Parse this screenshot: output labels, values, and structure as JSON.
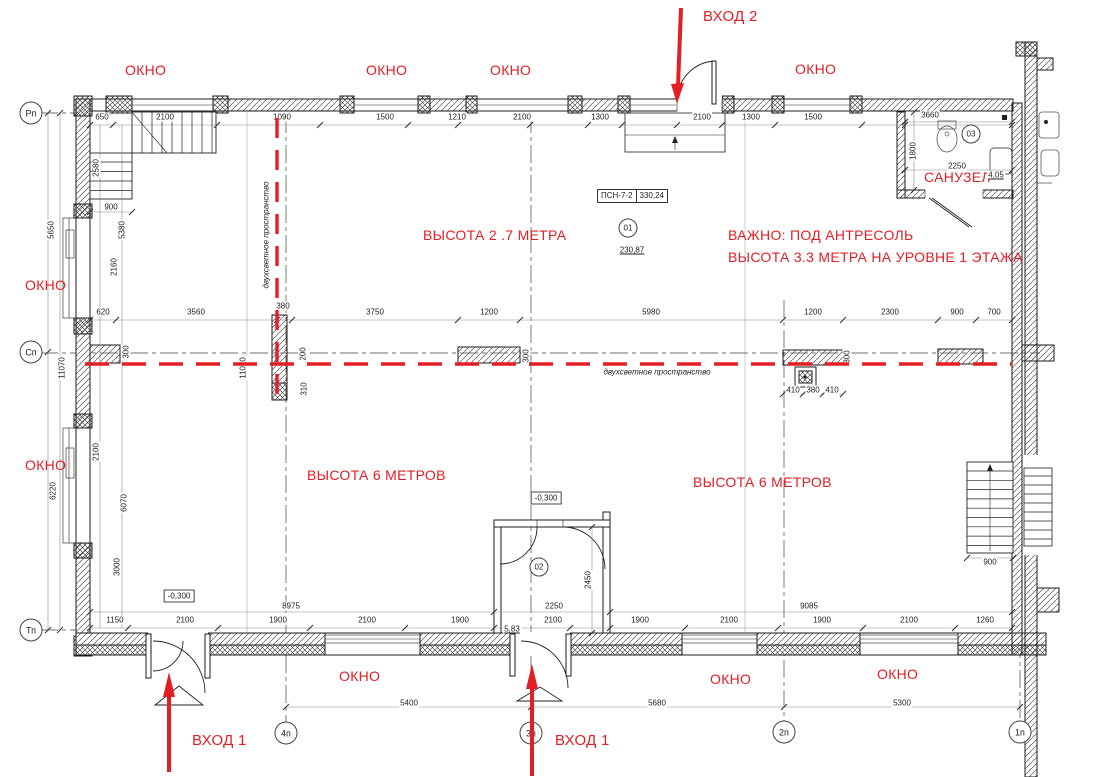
{
  "palette": {
    "red": "#e31e24",
    "line": "#1c1c1c",
    "dim_text": "#222222",
    "background": "#ffffff"
  },
  "area_tag": {
    "code": "ПСН-7-2",
    "area": "330,24"
  },
  "red_annotations": [
    {
      "text": "ВХОД 2",
      "x": 703,
      "y": 9,
      "size": 15
    },
    {
      "text": "ОКНО",
      "x": 125,
      "y": 62
    },
    {
      "text": "ОКНО",
      "x": 366,
      "y": 62
    },
    {
      "text": "ОКНО",
      "x": 490,
      "y": 62
    },
    {
      "text": "ОКНО",
      "x": 795,
      "y": 61
    },
    {
      "text": "ОКНО",
      "x": 25,
      "y": 277
    },
    {
      "text": "ОКНО",
      "x": 25,
      "y": 457
    },
    {
      "text": "ВЫСОТА 2 .7 МЕТРА",
      "x": 423,
      "y": 227
    },
    {
      "text": "ВАЖНО: ПОД АНТРЕСОЛЬ",
      "x": 728,
      "y": 227
    },
    {
      "text": "ВЫСОТА 3.3 МЕТРА НА УРОВНЕ 1 ЭТАЖА",
      "x": 728,
      "y": 249
    },
    {
      "text": "ВЫСОТА 6 МЕТРОВ",
      "x": 307,
      "y": 467
    },
    {
      "text": "ВЫСОТА 6 МЕТРОВ",
      "x": 693,
      "y": 474
    },
    {
      "text": "САНУЗЕЛ",
      "x": 924,
      "y": 169
    },
    {
      "text": "ОКНО",
      "x": 339,
      "y": 668
    },
    {
      "text": "ОКНО",
      "x": 710,
      "y": 671
    },
    {
      "text": "ОКНО",
      "x": 877,
      "y": 666
    },
    {
      "text": "ВХОД 1",
      "x": 192,
      "y": 733,
      "size": 15
    },
    {
      "text": "ВХОД 1",
      "x": 555,
      "y": 733,
      "size": 15
    }
  ],
  "grid_bubbles": [
    {
      "text": "Рп",
      "x": 31,
      "y": 113
    },
    {
      "text": "Сп",
      "x": 31,
      "y": 352
    },
    {
      "text": "Тп",
      "x": 31,
      "y": 630
    },
    {
      "text": "4п",
      "x": 286,
      "y": 733
    },
    {
      "text": "3п",
      "x": 531,
      "y": 733
    },
    {
      "text": "2п",
      "x": 784,
      "y": 732
    },
    {
      "text": "1п",
      "x": 1020,
      "y": 732
    }
  ],
  "circles": [
    {
      "text": "01",
      "x": 628,
      "y": 228
    },
    {
      "text": "02",
      "x": 539,
      "y": 567
    },
    {
      "text": "03",
      "x": 971,
      "y": 134
    }
  ],
  "level_boxes": [
    {
      "text": "-0,300",
      "x": 179,
      "y": 596
    },
    {
      "text": "-0,300",
      "x": 546,
      "y": 498
    }
  ],
  "underlined": [
    {
      "text": "230,87",
      "x": 632,
      "y": 250
    },
    {
      "text": "4,05",
      "x": 996,
      "y": 175
    },
    {
      "text": "5,83",
      "x": 512,
      "y": 629
    }
  ],
  "notes": [
    {
      "text": "двухсветное пространство",
      "x": 657,
      "y": 372
    },
    {
      "text": "двухсветное пространство",
      "x": 266,
      "y": 235,
      "rot": 1
    }
  ],
  "dims": [
    {
      "text": "650",
      "x": 102,
      "y": 117
    },
    {
      "text": "2100",
      "x": 165,
      "y": 117
    },
    {
      "text": "1090",
      "x": 282,
      "y": 117
    },
    {
      "text": "1500",
      "x": 385,
      "y": 117
    },
    {
      "text": "1210",
      "x": 457,
      "y": 117
    },
    {
      "text": "2100",
      "x": 522,
      "y": 117
    },
    {
      "text": "1300",
      "x": 600,
      "y": 117
    },
    {
      "text": "2100",
      "x": 702,
      "y": 117
    },
    {
      "text": "1300",
      "x": 751,
      "y": 117
    },
    {
      "text": "1500",
      "x": 813,
      "y": 117
    },
    {
      "text": "3660",
      "x": 930,
      "y": 115
    },
    {
      "text": "620",
      "x": 103,
      "y": 312
    },
    {
      "text": "3560",
      "x": 196,
      "y": 312
    },
    {
      "text": "380",
      "x": 283,
      "y": 306
    },
    {
      "text": "3750",
      "x": 375,
      "y": 312
    },
    {
      "text": "1200",
      "x": 489,
      "y": 312
    },
    {
      "text": "5980",
      "x": 651,
      "y": 312
    },
    {
      "text": "1200",
      "x": 813,
      "y": 312
    },
    {
      "text": "2300",
      "x": 890,
      "y": 312
    },
    {
      "text": "900",
      "x": 957,
      "y": 312
    },
    {
      "text": "700",
      "x": 994,
      "y": 312
    },
    {
      "text": "200",
      "x": 303,
      "y": 354,
      "rot": 1
    },
    {
      "text": "310",
      "x": 304,
      "y": 389,
      "rot": 1
    },
    {
      "text": "300",
      "x": 126,
      "y": 352,
      "rot": 1
    },
    {
      "text": "300",
      "x": 526,
      "y": 356,
      "rot": 1
    },
    {
      "text": "300",
      "x": 847,
      "y": 357,
      "rot": 1
    },
    {
      "text": "410",
      "x": 793,
      "y": 390
    },
    {
      "text": "380",
      "x": 813,
      "y": 390
    },
    {
      "text": "410",
      "x": 832,
      "y": 390
    },
    {
      "text": "1150",
      "x": 115,
      "y": 620
    },
    {
      "text": "2100",
      "x": 185,
      "y": 620
    },
    {
      "text": "1900",
      "x": 278,
      "y": 620
    },
    {
      "text": "2100",
      "x": 367,
      "y": 620
    },
    {
      "text": "1900",
      "x": 460,
      "y": 620
    },
    {
      "text": "2100",
      "x": 553,
      "y": 620
    },
    {
      "text": "1900",
      "x": 640,
      "y": 620
    },
    {
      "text": "2100",
      "x": 729,
      "y": 620
    },
    {
      "text": "1900",
      "x": 822,
      "y": 620
    },
    {
      "text": "2100",
      "x": 909,
      "y": 620
    },
    {
      "text": "1260",
      "x": 985,
      "y": 620
    },
    {
      "text": "8975",
      "x": 291,
      "y": 606
    },
    {
      "text": "2250",
      "x": 554,
      "y": 606
    },
    {
      "text": "9085",
      "x": 809,
      "y": 606
    },
    {
      "text": "5400",
      "x": 409,
      "y": 703
    },
    {
      "text": "5680",
      "x": 657,
      "y": 703
    },
    {
      "text": "5300",
      "x": 902,
      "y": 703
    },
    {
      "text": "5650",
      "x": 51,
      "y": 230,
      "rot": 1
    },
    {
      "text": "11070",
      "x": 62,
      "y": 368,
      "rot": 1
    },
    {
      "text": "6220",
      "x": 53,
      "y": 491,
      "rot": 1
    },
    {
      "text": "2580",
      "x": 96,
      "y": 168,
      "rot": 1
    },
    {
      "text": "900",
      "x": 111,
      "y": 207
    },
    {
      "text": "5380",
      "x": 122,
      "y": 230,
      "rot": 1
    },
    {
      "text": "2160",
      "x": 114,
      "y": 267,
      "rot": 1
    },
    {
      "text": "2100",
      "x": 96,
      "y": 452,
      "rot": 1
    },
    {
      "text": "6070",
      "x": 124,
      "y": 503,
      "rot": 1
    },
    {
      "text": "3000",
      "x": 117,
      "y": 567,
      "rot": 1
    },
    {
      "text": "11070",
      "x": 243,
      "y": 368,
      "rot": 1
    },
    {
      "text": "2450",
      "x": 588,
      "y": 580,
      "rot": 1
    },
    {
      "text": "1800",
      "x": 913,
      "y": 151,
      "rot": 1
    },
    {
      "text": "2250",
      "x": 957,
      "y": 166
    },
    {
      "text": "900",
      "x": 990,
      "y": 562
    }
  ]
}
